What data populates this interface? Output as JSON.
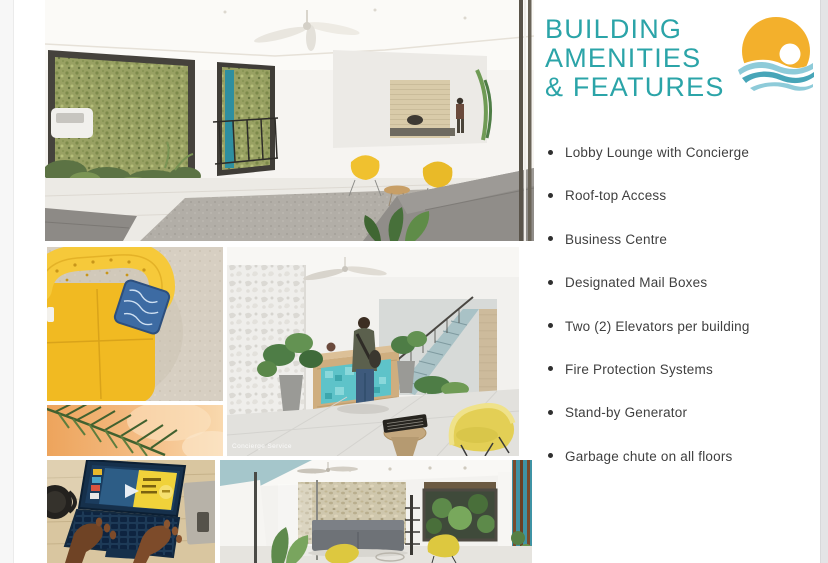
{
  "page": {
    "background": "#ffffff",
    "accent_teal": "#2BA4A8",
    "text_color": "#3F3F3F",
    "logo": {
      "name": "sun-over-waves-logo",
      "sun_yellow": "#F3B02C",
      "wave_light": "#8ECBD9",
      "wave_dark": "#47A5B8"
    }
  },
  "header": {
    "title_lines": [
      "BUILDING",
      "AMENITIES",
      "& FEATURES"
    ]
  },
  "amenities": {
    "items": [
      "Lobby Lounge with Concierge",
      "Roof-top Access",
      "Business Centre",
      "Designated Mail Boxes",
      "Two (2) Elevators per building",
      "Fire Protection Systems",
      "Stand-by Generator",
      "Garbage chute on all floors"
    ]
  },
  "gallery": {
    "images": [
      {
        "name": "lobby-lounge-render",
        "caption": ""
      },
      {
        "name": "yellow-sofa-top-view",
        "caption": ""
      },
      {
        "name": "palm-leaf-on-peach",
        "caption": ""
      },
      {
        "name": "concierge-desk-render",
        "caption": "Concierge Service"
      },
      {
        "name": "business-centre-laptop",
        "caption": ""
      },
      {
        "name": "lobby-seating-render",
        "caption": ""
      }
    ]
  }
}
